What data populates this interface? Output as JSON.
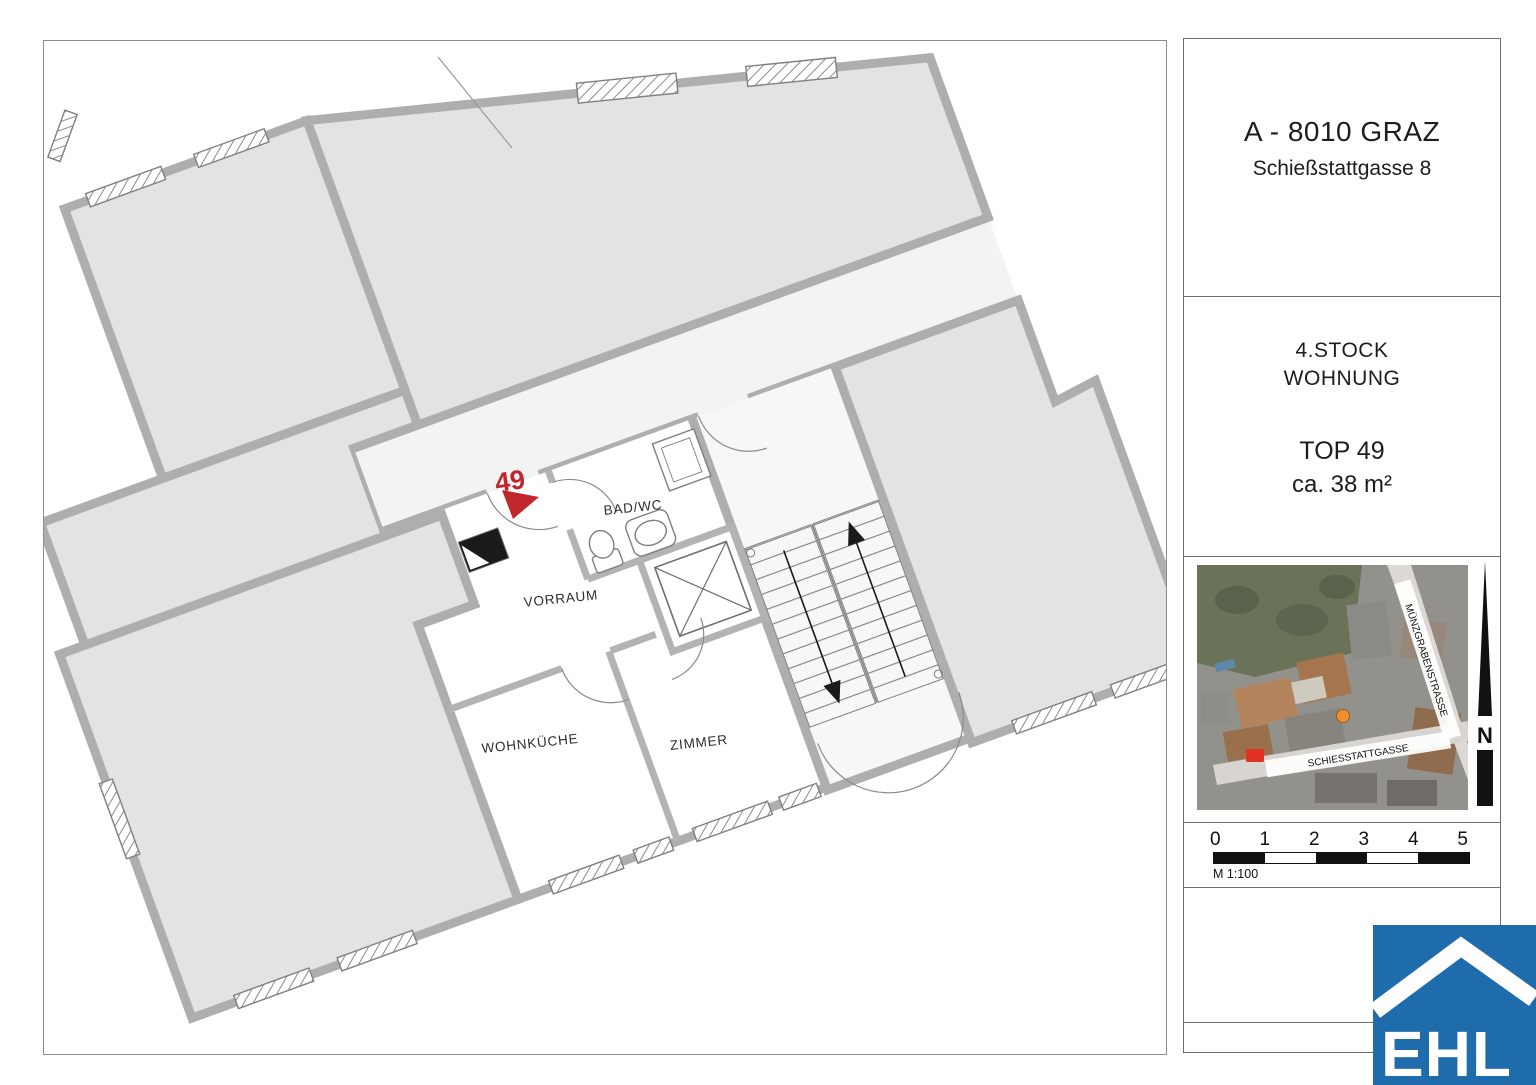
{
  "plan": {
    "unit_number": "49",
    "rooms": {
      "bathroom": "BAD/WC",
      "hall": "VORRAUM",
      "kitchen": "WOHNKÜCHE",
      "room": "ZIMMER"
    },
    "accent_red": "#c0272d"
  },
  "info_panel": {
    "address_line1": "A - 8010 GRAZ",
    "address_line2": "Schießstattgasse 8",
    "floor_line1": "4.STOCK",
    "floor_line2": "WOHNUNG",
    "top_line1": "TOP 49",
    "top_line2": "ca. 38 m²"
  },
  "map": {
    "street_diagonal": "MÜNZGRABENSTRASSE",
    "street_bottom": "SCHIESSTATTGASSE",
    "north_label": "N",
    "marker_orange": "#ef8f2a",
    "marker_red": "#e23127"
  },
  "scale": {
    "ticks": [
      "0",
      "1",
      "2",
      "3",
      "4",
      "5"
    ],
    "note": "M 1:100"
  },
  "logo": {
    "text": "EHL",
    "color": "#1f6cac"
  }
}
